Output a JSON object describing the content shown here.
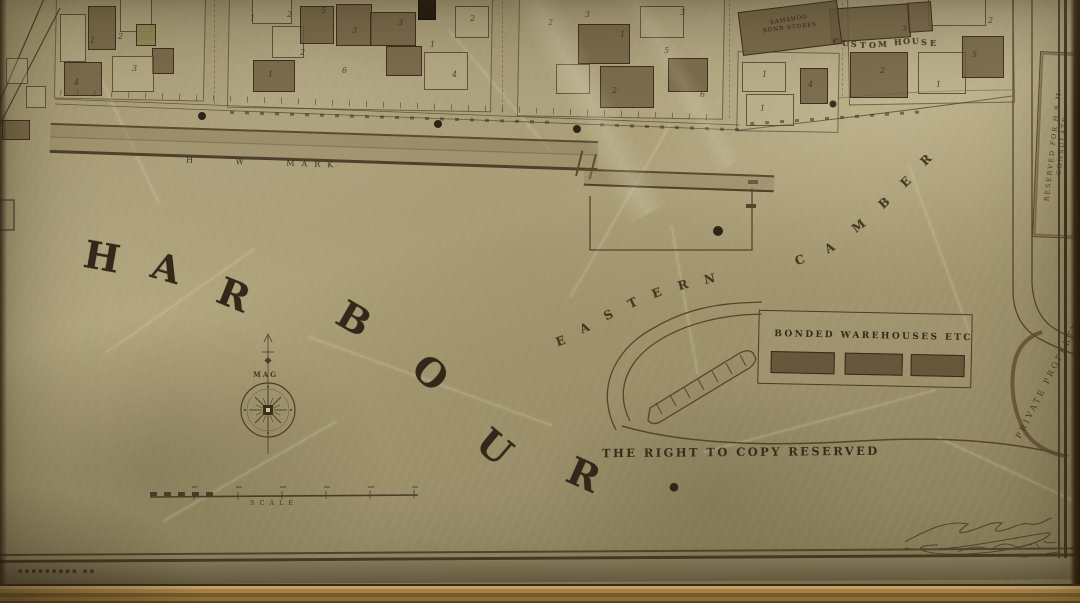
{
  "photo": {
    "paper_color": "#a89b74",
    "ink_color": "#3a2e1c",
    "frame_gold_color": "#c29a55",
    "signature_note": "illegible handwritten signature with date"
  },
  "map": {
    "harbour_word": {
      "text": "HARBOUR.",
      "letters": [
        {
          "ch": "H",
          "x": 84,
          "y": 234,
          "r": 10,
          "s": 38
        },
        {
          "ch": "A",
          "x": 152,
          "y": 246,
          "r": 16,
          "s": 37
        },
        {
          "ch": "R",
          "x": 218,
          "y": 272,
          "r": 22,
          "s": 38
        },
        {
          "ch": "B",
          "x": 338,
          "y": 296,
          "r": 30,
          "s": 38
        },
        {
          "ch": "O",
          "x": 414,
          "y": 350,
          "r": 42,
          "s": 38
        },
        {
          "ch": "U",
          "x": 478,
          "y": 424,
          "r": 40,
          "s": 38
        },
        {
          "ch": "R",
          "x": 568,
          "y": 452,
          "r": 24,
          "s": 38
        },
        {
          "ch": ".",
          "x": 666,
          "y": 448,
          "r": 0,
          "s": 46
        }
      ]
    },
    "camber_word": {
      "text": "EASTERN CAMBER",
      "letters": [
        {
          "ch": "E",
          "x": 556,
          "y": 334,
          "r": -20,
          "s": 12
        },
        {
          "ch": "A",
          "x": 580,
          "y": 321,
          "r": -24,
          "s": 12
        },
        {
          "ch": "S",
          "x": 604,
          "y": 308,
          "r": -26,
          "s": 12
        },
        {
          "ch": "T",
          "x": 628,
          "y": 296,
          "r": -26,
          "s": 12
        },
        {
          "ch": "E",
          "x": 652,
          "y": 286,
          "r": -22,
          "s": 12
        },
        {
          "ch": "R",
          "x": 678,
          "y": 278,
          "r": -16,
          "s": 12
        },
        {
          "ch": "N",
          "x": 704,
          "y": 272,
          "r": -12,
          "s": 12
        },
        {
          "ch": "C",
          "x": 795,
          "y": 253,
          "r": -22,
          "s": 12
        },
        {
          "ch": "A",
          "x": 825,
          "y": 241,
          "r": -30,
          "s": 12
        },
        {
          "ch": "M",
          "x": 852,
          "y": 219,
          "r": -38,
          "s": 12
        },
        {
          "ch": "B",
          "x": 879,
          "y": 196,
          "r": -42,
          "s": 12
        },
        {
          "ch": "E",
          "x": 901,
          "y": 175,
          "r": -44,
          "s": 12
        },
        {
          "ch": "R",
          "x": 921,
          "y": 153,
          "r": -45,
          "s": 12
        }
      ]
    },
    "custom_house_word": {
      "text": "CUSTOM HOUSE",
      "letters": [
        {
          "ch": "C",
          "x": 833,
          "y": 36,
          "r": 8,
          "s": 8
        },
        {
          "ch": "U",
          "x": 842,
          "y": 38,
          "r": 6,
          "s": 8
        },
        {
          "ch": "S",
          "x": 851,
          "y": 39,
          "r": 4,
          "s": 8
        },
        {
          "ch": "T",
          "x": 860,
          "y": 40,
          "r": 2,
          "s": 8
        },
        {
          "ch": "O",
          "x": 869,
          "y": 40,
          "r": 0,
          "s": 8
        },
        {
          "ch": "M",
          "x": 878,
          "y": 39,
          "r": -2,
          "s": 8
        },
        {
          "ch": "H",
          "x": 894,
          "y": 37,
          "r": -4,
          "s": 8
        },
        {
          "ch": "O",
          "x": 903,
          "y": 36,
          "r": -4,
          "s": 8
        },
        {
          "ch": "U",
          "x": 912,
          "y": 36,
          "r": -3,
          "s": 8
        },
        {
          "ch": "S",
          "x": 921,
          "y": 37,
          "r": -2,
          "s": 8
        },
        {
          "ch": "E",
          "x": 930,
          "y": 38,
          "r": 0,
          "s": 8
        }
      ]
    },
    "labels": {
      "hw_mark": "H W MARK",
      "mag": "MAG",
      "scale": "SCALE",
      "copyright": "THE RIGHT TO COPY RESERVED",
      "bonded_warehouses": "BONDED WAREHOUSES ETC",
      "bond_stores_line1": "SAMSHOO",
      "bond_stores_line2": "BOND STORES",
      "consulate_line1": "RESERVED FOR H.B.M.",
      "consulate_line2": "CONSULATE",
      "private_property": "PRIVATE PROPERTY",
      "imprint": "▪▪▪▪▪▪▪▪▪ ▪▪"
    },
    "lot_numbers": [
      {
        "n": "1",
        "x": 90,
        "y": 36
      },
      {
        "n": "2",
        "x": 118,
        "y": 32
      },
      {
        "n": "4",
        "x": 74,
        "y": 78
      },
      {
        "n": "3",
        "x": 132,
        "y": 64
      },
      {
        "n": "1",
        "x": 250,
        "y": 14
      },
      {
        "n": "2",
        "x": 287,
        "y": 10
      },
      {
        "n": "5",
        "x": 321,
        "y": 6
      },
      {
        "n": "3",
        "x": 352,
        "y": 26
      },
      {
        "n": "2",
        "x": 300,
        "y": 48
      },
      {
        "n": "1",
        "x": 268,
        "y": 70
      },
      {
        "n": "6",
        "x": 342,
        "y": 66
      },
      {
        "n": "3",
        "x": 398,
        "y": 18
      },
      {
        "n": "1",
        "x": 430,
        "y": 40
      },
      {
        "n": "4",
        "x": 452,
        "y": 70
      },
      {
        "n": "2",
        "x": 470,
        "y": 14
      },
      {
        "n": "2",
        "x": 548,
        "y": 18
      },
      {
        "n": "3",
        "x": 585,
        "y": 10
      },
      {
        "n": "1",
        "x": 620,
        "y": 30
      },
      {
        "n": "2",
        "x": 612,
        "y": 86
      },
      {
        "n": "5",
        "x": 664,
        "y": 46
      },
      {
        "n": "6",
        "x": 700,
        "y": 90
      },
      {
        "n": "3",
        "x": 680,
        "y": 8
      },
      {
        "n": "1",
        "x": 762,
        "y": 70
      },
      {
        "n": "1",
        "x": 760,
        "y": 104
      },
      {
        "n": "4",
        "x": 808,
        "y": 80
      },
      {
        "n": "3",
        "x": 902,
        "y": 24
      },
      {
        "n": "2",
        "x": 880,
        "y": 66
      },
      {
        "n": "1",
        "x": 936,
        "y": 80
      },
      {
        "n": "5",
        "x": 972,
        "y": 50
      },
      {
        "n": "2",
        "x": 988,
        "y": 16
      }
    ]
  }
}
